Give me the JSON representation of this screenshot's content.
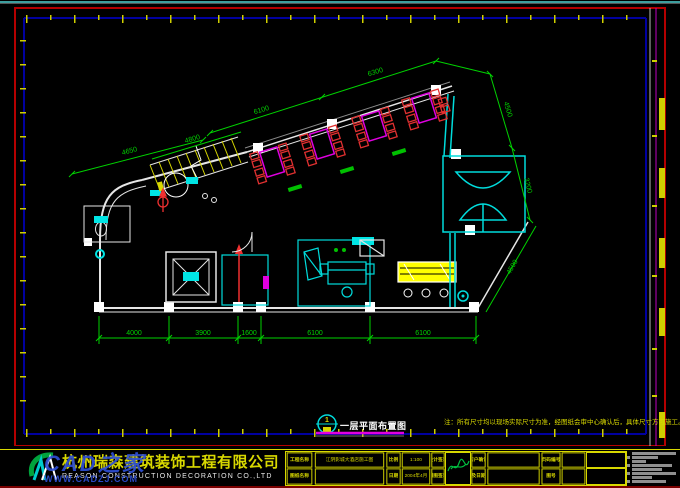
{
  "watermark": {
    "brand": "CAD之家",
    "url": "WWW.CADZJ.COM"
  },
  "footer": {
    "company_cn": "杭州瑞森建筑装饰工程有限公司",
    "company_en": "REASON CONSTRUCTION DECORATION CO.,LTD",
    "table": {
      "row1": {
        "name_label": "工程名称",
        "name_value": "江阴影城大酒店施工图",
        "scale_label": "比例",
        "scale_value": "1:100",
        "seal_label": "设计签章",
        "confirm_label": "客户确认",
        "page_label": "页码编号",
        "confirm_value": "",
        "page_value": ""
      },
      "row2": {
        "name_label": "图纸名称",
        "name_value": "",
        "date_label": "日期",
        "date_value": "2004年4月",
        "seal_label": "制图签章",
        "confirm_label": "及日期",
        "page_label": "图号",
        "confirm_value": "",
        "page_value": ""
      }
    }
  },
  "drawing": {
    "bubble_number": "1",
    "title": "一层平面布置图",
    "note": "注：所有尺寸均以现场实际尺寸为准，经图纸会审中心确认后，具体尺寸方可施工。",
    "dims": {
      "left_slant": "4650",
      "stair": "4800",
      "window_a": "6100",
      "window_b": "6300",
      "right_upper": "4500",
      "right_mid": "3200",
      "right_lower": "4500",
      "bottom": [
        "4000",
        "3900",
        "1600",
        "6100",
        "6100"
      ]
    }
  },
  "colors": {
    "dim_green": "#00d200",
    "wall_white": "#e6e6e6",
    "cyan": "#00dcdc",
    "red": "#f03030",
    "magenta": "#e000e0",
    "yellow": "#e8e800",
    "frame_red": "#b40000",
    "frame_navy": "#0000a0",
    "watermark_blue": "#2e4fd4"
  }
}
